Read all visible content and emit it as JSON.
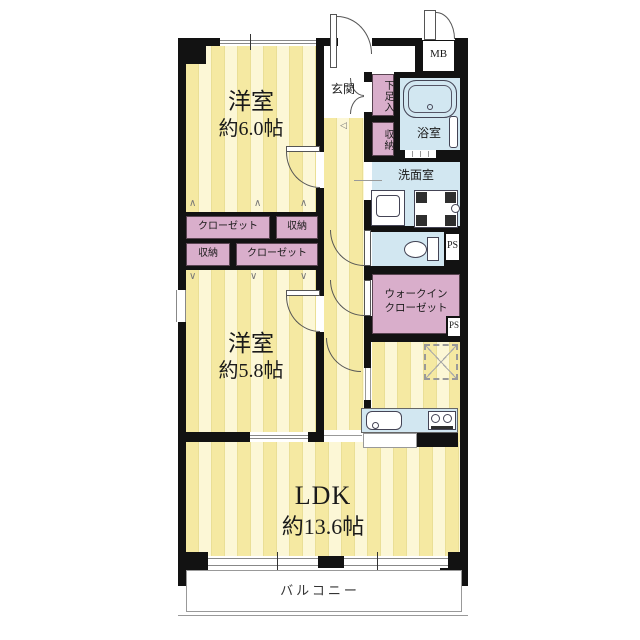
{
  "colors": {
    "wall": "#121212",
    "tatami_dark": "#f5e9a2",
    "tatami_light": "#fcf7d6",
    "stripe_line": "#eadf96",
    "closet_pink": "#d9aecb",
    "wet_blue": "#d2e7f1",
    "text": "#1a1a1a"
  },
  "rooms": {
    "bedroom1": {
      "name": "洋室",
      "size": "約6.0帖"
    },
    "bedroom2": {
      "name": "洋室",
      "size": "約5.8帖"
    },
    "ldk": {
      "name": "LDK",
      "size": "約13.6帖"
    },
    "balcony": {
      "name": "バルコニー"
    },
    "entrance": {
      "name": "玄関"
    },
    "shoe_cupboard": {
      "name": "下足入"
    },
    "entrance_storage": {
      "name": "収納"
    },
    "bathroom": {
      "name": "浴室"
    },
    "washroom": {
      "name": "洗面室"
    },
    "walk_in_closet": {
      "name_line1": "ウォークイン",
      "name_line2": "クローゼット"
    },
    "closet_upper": {
      "name": "クローゼット"
    },
    "storage_upper": {
      "name": "収納"
    },
    "storage_lower": {
      "name": "収納"
    },
    "closet_lower": {
      "name": "クローゼット"
    },
    "meter_box": {
      "name": "MB"
    },
    "pipe_space_upper": {
      "name": "PS"
    },
    "pipe_space_lower": {
      "name": "PS"
    }
  },
  "marks": {
    "fold_up": "∧",
    "fold_down": "∨",
    "entry_step": "◁"
  }
}
